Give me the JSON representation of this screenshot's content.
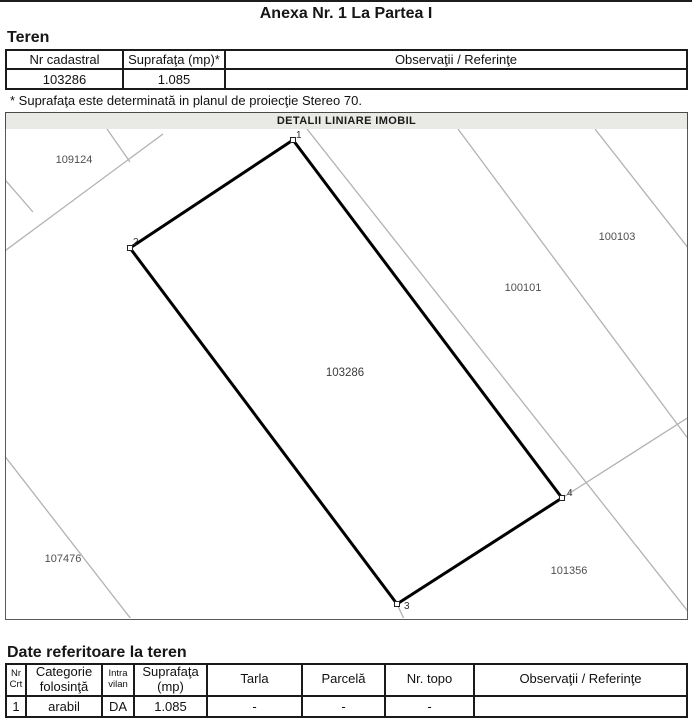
{
  "document": {
    "title": "Anexa Nr. 1 La Partea I"
  },
  "teren": {
    "heading": "Teren",
    "table": {
      "headers": [
        "Nr cadastral",
        "Suprafaţa (mp)*",
        "Observaţii / Referinţe"
      ],
      "rows": [
        [
          "103286",
          "1.085",
          ""
        ]
      ]
    },
    "note": "* Suprafaţa este determinată in planul de proiecţie Stereo 70."
  },
  "map": {
    "title": "DETALII LINIARE IMOBIL",
    "subject_parcel_number": "103286",
    "vertices": [
      {
        "label": "1"
      },
      {
        "label": "2"
      },
      {
        "label": "3"
      },
      {
        "label": "4"
      }
    ],
    "labels": [
      {
        "name": "parcel-109124",
        "text": "109124"
      },
      {
        "name": "parcel-100103",
        "text": "100103"
      },
      {
        "name": "parcel-100101",
        "text": "100101"
      },
      {
        "name": "parcel-103286",
        "text": "103286"
      },
      {
        "name": "parcel-107476",
        "text": "107476"
      },
      {
        "name": "parcel-101356",
        "text": "101356"
      }
    ],
    "colors": {
      "boundary_gray": "#b2b2b2",
      "subject_outline": "#000000",
      "label_text": "#4f4f4f",
      "titlebar_bg": "#e9e9e6"
    }
  },
  "date_teren": {
    "heading": "Date referitoare la teren",
    "table": {
      "headers": [
        [
          "Nr",
          "Crt"
        ],
        [
          "Categorie",
          "folosinţă"
        ],
        [
          "Intra",
          "vilan"
        ],
        [
          "Suprafaţa",
          "(mp)"
        ],
        [
          "Tarla",
          ""
        ],
        [
          "Parcelă",
          ""
        ],
        [
          "Nr. topo",
          ""
        ],
        [
          "Observaţii / Referinţe",
          ""
        ]
      ],
      "rows": [
        [
          "1",
          "arabil",
          "DA",
          "1.085",
          "-",
          "-",
          "-",
          ""
        ]
      ]
    }
  }
}
